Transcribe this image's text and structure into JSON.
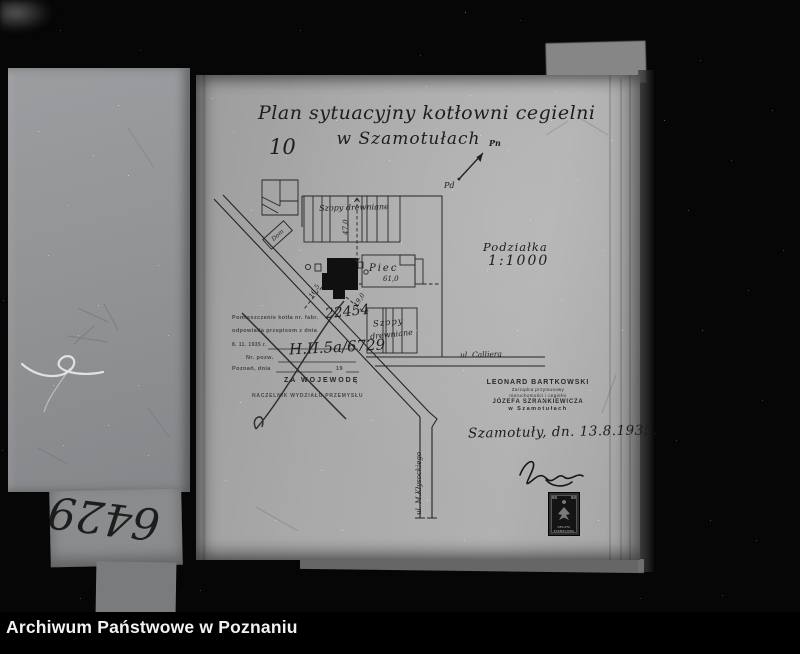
{
  "archive_footer": {
    "label": "Archiwum Państwowe w Poznaniu"
  },
  "left_page": {
    "inventory_number": "6429"
  },
  "plan": {
    "title_line1": "Plan sytuacyjny kotłowni cegielni",
    "title_line2": "w Szamotułach",
    "page_number": "10",
    "compass": {
      "north": "Pn",
      "south": "Pd"
    },
    "scale": {
      "label": "Podziałka",
      "value": "1:1000"
    },
    "map": {
      "buildings": {
        "dom": "Dom",
        "upper_sheds": "Szopy drewniane",
        "kiln": "Piec",
        "kiln_dimension": "61,0",
        "lower_sheds_line1": "Szopy",
        "lower_sheds_line2": "drewniane"
      },
      "measurements": {
        "sheds_to_boiler": "47,0",
        "to_road": "16,5",
        "to_sheds": "19,0"
      },
      "streets": {
        "calliera": "ul. Calliera",
        "klysockiego": "ul. M.Kłysockiego"
      }
    },
    "approval_stamp": {
      "line1": "Pomieszczenie kotła nr. fabr.",
      "boiler_number": "22454",
      "line2": "odpowiada przepisom z dnia",
      "line3": "8. 11. 1935 r.",
      "line4": "Nr. pozw.",
      "permit_number": "H.II.5a/6729",
      "line5": "Poznań, dnia",
      "line5_year": "19",
      "line6": "ZA WOJEWODĘ",
      "line7": "NACZELNIK WYDZIAŁU PRZEMYSŁU"
    },
    "manager_stamp": {
      "line1": "LEONARD BARTKOWSKI",
      "line2": "Zarządca przymusowy",
      "line3": "nieruchomości i cegielni",
      "line4": "JÓZEFA SZRANKIEWICZA",
      "line5": "w Szamotułach"
    },
    "dated_signature": {
      "place_date": "Szamotuły, dn. 13.8.1935."
    },
    "revenue_stamp": {
      "value_left": "50",
      "value_right": "50",
      "caption_line1": "OPŁATA",
      "caption_line2": "STEMPLOWA"
    }
  },
  "colors": {
    "photo_background": "#060606",
    "paper": "#aaaaaa",
    "ink": "#1d1d1d",
    "footer_text": "#f2f2f2"
  }
}
